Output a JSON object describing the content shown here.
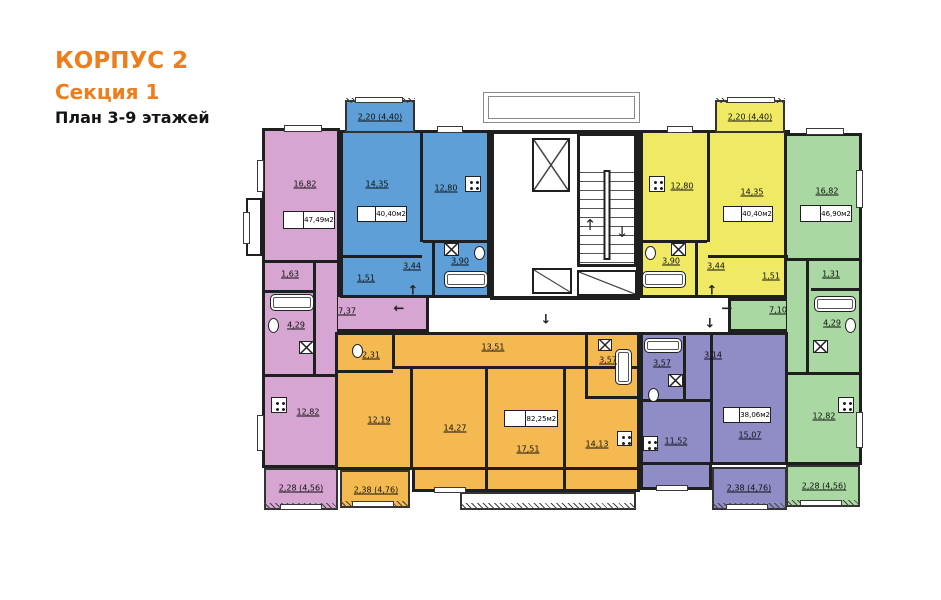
{
  "title": {
    "building": "КОРПУС 2",
    "section": "Секция 1",
    "plan": "План 3-9 этажей"
  },
  "colors": {
    "accent_orange": "#ee7d1e",
    "unit_pink": "#d6a5d1",
    "unit_blue": "#5e9fd7",
    "unit_yellow": "#f0e964",
    "unit_green": "#a9d8a2",
    "unit_orange": "#f4ba51",
    "unit_violet": "#908cc6",
    "wall": "#1f1f1f"
  },
  "units": {
    "pink": {
      "total_area": "47,49м2",
      "rooms": {
        "living": "16,82",
        "storage": "1,63",
        "bathroom": "4,29",
        "hall": "7,37",
        "kitchen": "12,82"
      },
      "balcony": "2,28 (4,56)"
    },
    "blue": {
      "total_area": "40,40м2",
      "rooms": {
        "room": "14,35",
        "kitchen_living": "12,80",
        "hall": "3,44",
        "bathroom": "3,90",
        "storage": "1,51"
      },
      "balcony": "2,20 (4,40)"
    },
    "yellow": {
      "total_area": "40,40м2",
      "rooms": {
        "kitchen_living": "12,80",
        "room": "14,35",
        "bathroom": "3,90",
        "hall": "3,44",
        "storage": "1,51"
      },
      "balcony": "2,20 (4,40)"
    },
    "green": {
      "total_area": "46,90м2",
      "rooms": {
        "living": "16,82",
        "storage": "1,31",
        "bathroom": "4,29",
        "hall": "7,10",
        "kitchen": "12,82"
      },
      "balcony": "2,28 (4,56)"
    },
    "orange": {
      "total_area": "82,25м2",
      "rooms": {
        "wc": "2,31",
        "room1": "12,19",
        "corridor": "13,51",
        "room2": "14,27",
        "room3": "17,51",
        "kitchen": "14,13",
        "bathroom": "3,57"
      },
      "balcony": "2,38 (4,76)"
    },
    "violet": {
      "total_area": "38,06м2",
      "rooms": {
        "hall": "3,14",
        "bathroom": "3,57",
        "kitchen": "11,52",
        "room": "15,07"
      },
      "balcony": "2,38 (4,76)"
    }
  },
  "arrows": {
    "a1": "↑",
    "a2": "←",
    "a3": "↓",
    "a4": "↑",
    "a5": "→",
    "a6": "↓"
  }
}
